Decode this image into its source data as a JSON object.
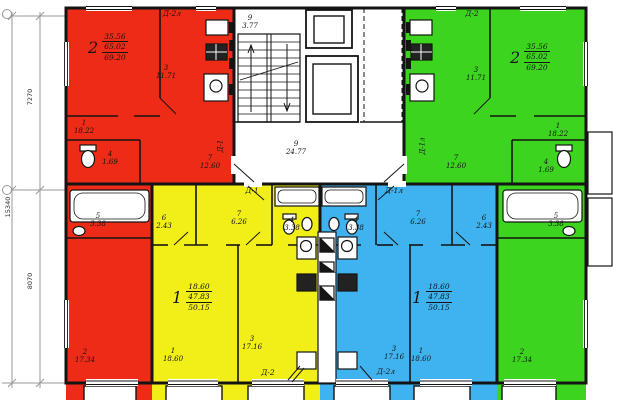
{
  "meta": {
    "drawing_type": "apartment-building-floor-plan"
  },
  "colors": {
    "apartment_red": "#ee2b17",
    "apartment_yellow": "#f2ee18",
    "apartment_blue": "#3fb3ef",
    "apartment_green": "#3cd41e",
    "walls": "#141414",
    "dim_lines": "#8a8a8a"
  },
  "dimensions": {
    "overall": "15340",
    "upper": "7270",
    "lower": "8070"
  },
  "core": {
    "stairs_no": "9",
    "stairs_area": "3.77",
    "hall_no": "9",
    "hall_area": "24.77"
  },
  "apartments": {
    "red": {
      "type": "2",
      "area_living": "35.56",
      "area_total": "65.02",
      "area_full": "69.20",
      "door_top": "Д-2л",
      "door_entry": "Д-1",
      "rooms": [
        {
          "no": "1",
          "area": "18.22"
        },
        {
          "no": "2",
          "area": "17.34"
        },
        {
          "no": "3",
          "area": "11.71"
        },
        {
          "no": "4",
          "area": "1.69"
        },
        {
          "no": "5",
          "area": "3.38"
        },
        {
          "no": "7",
          "area": "12.60"
        }
      ]
    },
    "green": {
      "type": "2",
      "area_living": "35.56",
      "area_total": "65.02",
      "area_full": "69.20",
      "door_top": "Д-2",
      "door_entry": "Д-1л",
      "rooms": [
        {
          "no": "1",
          "area": "18.22"
        },
        {
          "no": "2",
          "area": "17.34"
        },
        {
          "no": "3",
          "area": "11.71"
        },
        {
          "no": "4",
          "area": "1.69"
        },
        {
          "no": "5",
          "area": "3.38"
        },
        {
          "no": "7",
          "area": "12.60"
        }
      ]
    },
    "yellow": {
      "type": "1",
      "area_living": "18.60",
      "area_total": "47.83",
      "area_full": "50.15",
      "door_bottom": "Д-2",
      "door_entry": "Д-1",
      "rooms": [
        {
          "no": "1",
          "area": "18.60"
        },
        {
          "no": "3",
          "area": "17.16"
        },
        {
          "no": "4",
          "area": "3.38"
        },
        {
          "no": "6",
          "area": "2.43"
        },
        {
          "no": "7",
          "area": "6.26"
        }
      ]
    },
    "blue": {
      "type": "1",
      "area_living": "18.60",
      "area_total": "47.83",
      "area_full": "50.15",
      "door_bottom": "Д-2л",
      "door_entry": "Д-1л",
      "rooms": [
        {
          "no": "1",
          "area": "18.60"
        },
        {
          "no": "3",
          "area": "17.16"
        },
        {
          "no": "4",
          "area": "3.38"
        },
        {
          "no": "6",
          "area": "2.43"
        },
        {
          "no": "7",
          "area": "6.26"
        }
      ]
    }
  }
}
